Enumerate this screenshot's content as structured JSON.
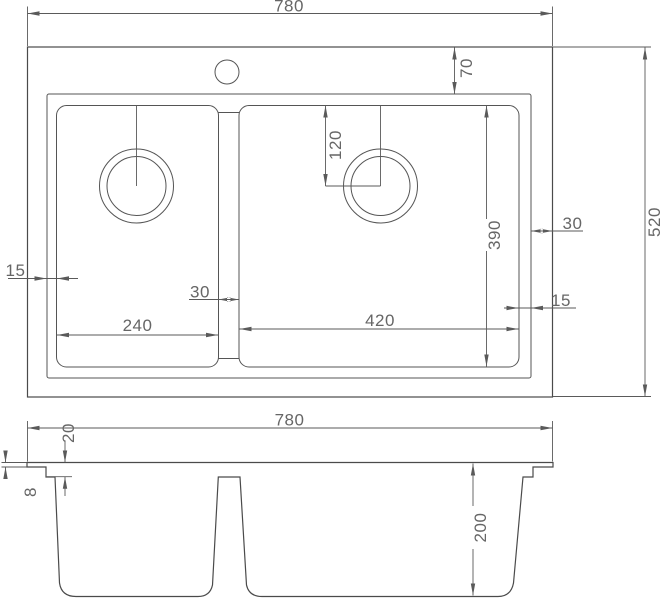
{
  "drawing": {
    "type": "technical-dimension-drawing",
    "subject": "double-bowl sink, plan view and front section view",
    "colors": {
      "line": "#555555",
      "text": "#666666",
      "background": "#ffffff"
    },
    "top_view": {
      "overall_width": "780",
      "overall_depth": "520",
      "top_edge_to_rim": "70",
      "rim_to_outer_right": "30",
      "bowl_to_rim_right": "15",
      "bowl_to_rim_left": "15",
      "drain_center_from_bowl_top": "120",
      "bowl_front_to_back": "390",
      "divider_width": "30",
      "left_bowl_width": "240",
      "right_bowl_width": "420"
    },
    "front_view": {
      "overall_width": "780",
      "rim_drop": "20",
      "flange_thickness": "8",
      "bowl_depth": "200"
    }
  }
}
